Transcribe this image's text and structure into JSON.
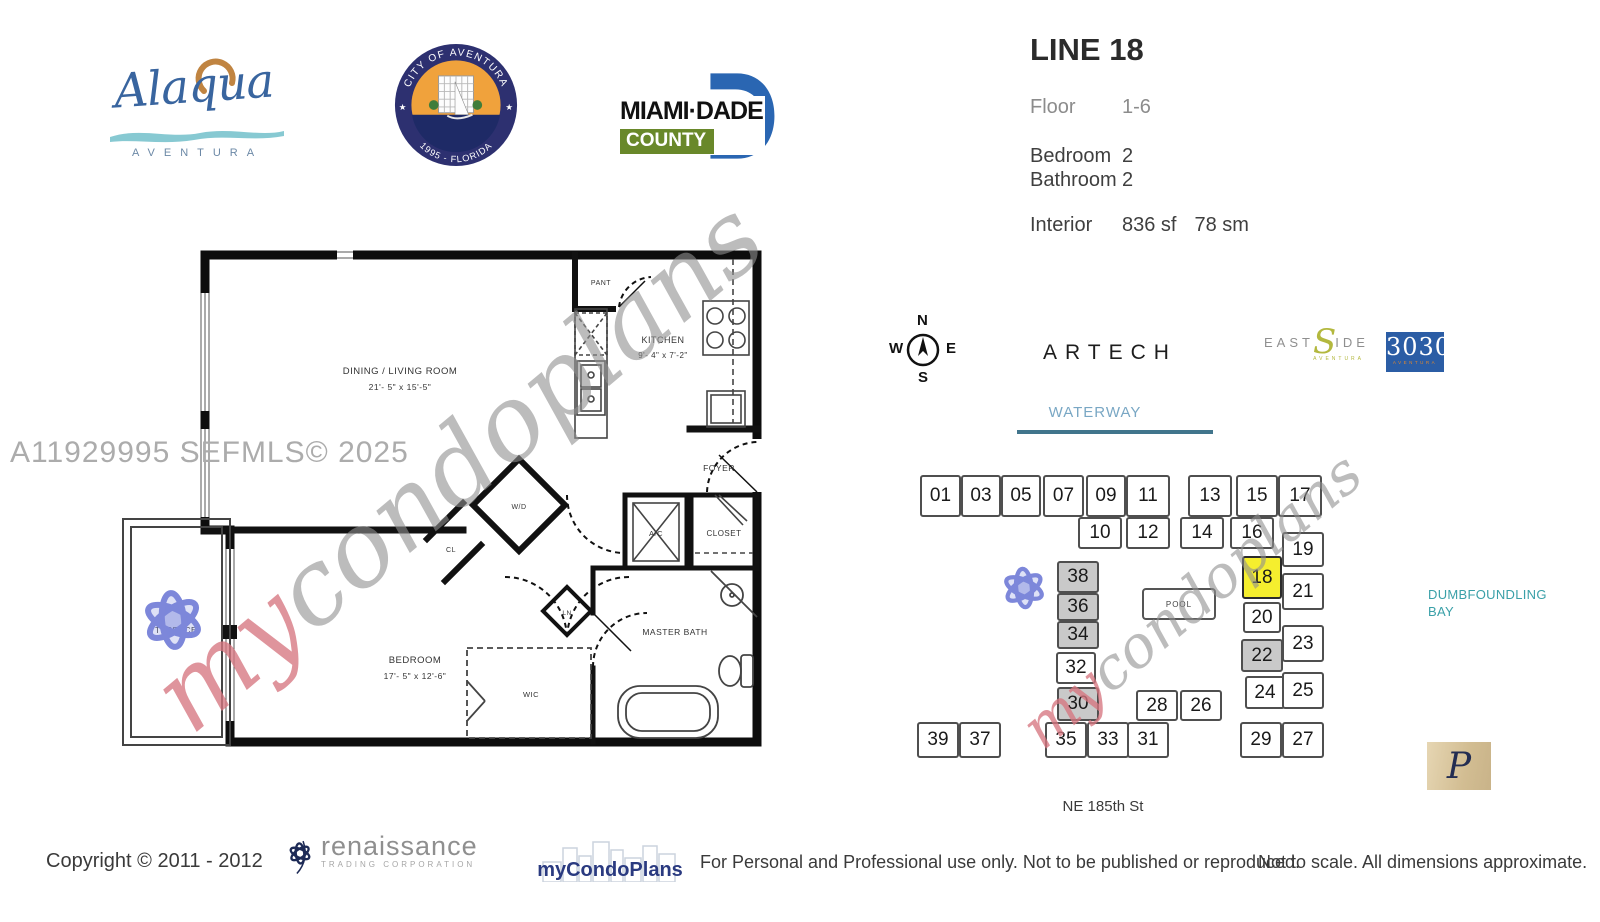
{
  "header": {
    "alaqua": {
      "name": "Alaqua",
      "subtitle": "AVENTURA"
    },
    "seal": {
      "arc_top": "CITY OF AVENTURA",
      "arc_bottom": "1995 - FLORIDA",
      "star": "★"
    },
    "miamidade": {
      "name": "MIAMI·DADE",
      "county": "COUNTY"
    }
  },
  "info": {
    "title": "LINE 18",
    "floor_label": "Floor",
    "floor_value": "1-6",
    "bedroom_label": "Bedroom",
    "bedroom_value": "2",
    "bathroom_label": "Bathroom",
    "bathroom_value": "2",
    "interior_label": "Interior",
    "interior_sf": "836 sf",
    "interior_sm": "78 sm"
  },
  "compass": {
    "n": "N",
    "e": "E",
    "s": "S",
    "w": "W"
  },
  "brands": {
    "artech": "ARTECH",
    "eastside": {
      "east": "EAST",
      "s": "S",
      "ide": "IDE",
      "sub": "AVENTURA"
    },
    "t3030": {
      "num": "3030",
      "sub": "AVENTURA"
    },
    "p_logo": "P"
  },
  "sitemap": {
    "waterway": "WATERWAY",
    "street": "NE 185th St",
    "bay": [
      "DUMBFOUNDLING",
      "BAY"
    ],
    "pool": "POOL",
    "highlight_color": "#f5ee2e",
    "shaded_color": "#c9c9c9",
    "units": [
      {
        "n": "01",
        "x": 920,
        "y": 475,
        "w": 41,
        "h": 42
      },
      {
        "n": "03",
        "x": 961,
        "y": 475,
        "w": 40,
        "h": 42
      },
      {
        "n": "05",
        "x": 1001,
        "y": 475,
        "w": 40,
        "h": 42
      },
      {
        "n": "07",
        "x": 1043,
        "y": 475,
        "w": 41,
        "h": 42
      },
      {
        "n": "09",
        "x": 1086,
        "y": 475,
        "w": 40,
        "h": 42
      },
      {
        "n": "11",
        "x": 1126,
        "y": 475,
        "w": 44,
        "h": 42
      },
      {
        "n": "13",
        "x": 1188,
        "y": 475,
        "w": 44,
        "h": 42
      },
      {
        "n": "15",
        "x": 1236,
        "y": 475,
        "w": 42,
        "h": 42
      },
      {
        "n": "17",
        "x": 1278,
        "y": 475,
        "w": 44,
        "h": 42
      },
      {
        "n": "10",
        "x": 1078,
        "y": 517,
        "w": 44,
        "h": 32
      },
      {
        "n": "12",
        "x": 1126,
        "y": 517,
        "w": 44,
        "h": 32
      },
      {
        "n": "14",
        "x": 1180,
        "y": 517,
        "w": 44,
        "h": 32
      },
      {
        "n": "16",
        "x": 1230,
        "y": 517,
        "w": 44,
        "h": 32
      },
      {
        "n": "19",
        "x": 1282,
        "y": 532,
        "w": 42,
        "h": 35
      },
      {
        "n": "38",
        "x": 1057,
        "y": 561,
        "w": 42,
        "h": 32,
        "c": "gray"
      },
      {
        "n": "36",
        "x": 1057,
        "y": 593,
        "w": 42,
        "h": 28,
        "c": "gray"
      },
      {
        "n": "34",
        "x": 1057,
        "y": 621,
        "w": 42,
        "h": 28,
        "c": "gray"
      },
      {
        "n": "32",
        "x": 1056,
        "y": 652,
        "w": 40,
        "h": 32
      },
      {
        "n": "30",
        "x": 1057,
        "y": 687,
        "w": 42,
        "h": 34,
        "c": "gray"
      },
      {
        "n": "18",
        "x": 1242,
        "y": 556,
        "w": 40,
        "h": 43,
        "c": "yellow"
      },
      {
        "n": "20",
        "x": 1243,
        "y": 602,
        "w": 38,
        "h": 31
      },
      {
        "n": "21",
        "x": 1282,
        "y": 573,
        "w": 42,
        "h": 37
      },
      {
        "n": "22",
        "x": 1241,
        "y": 639,
        "w": 42,
        "h": 33,
        "c": "gray"
      },
      {
        "n": "23",
        "x": 1282,
        "y": 625,
        "w": 42,
        "h": 37
      },
      {
        "n": "24",
        "x": 1245,
        "y": 676,
        "w": 40,
        "h": 33
      },
      {
        "n": "25",
        "x": 1282,
        "y": 672,
        "w": 42,
        "h": 37
      },
      {
        "n": "28",
        "x": 1136,
        "y": 690,
        "w": 42,
        "h": 31
      },
      {
        "n": "26",
        "x": 1180,
        "y": 690,
        "w": 42,
        "h": 31
      },
      {
        "n": "39",
        "x": 917,
        "y": 722,
        "w": 42,
        "h": 36
      },
      {
        "n": "37",
        "x": 959,
        "y": 722,
        "w": 42,
        "h": 36
      },
      {
        "n": "35",
        "x": 1045,
        "y": 722,
        "w": 42,
        "h": 36
      },
      {
        "n": "33",
        "x": 1087,
        "y": 722,
        "w": 42,
        "h": 36
      },
      {
        "n": "31",
        "x": 1127,
        "y": 722,
        "w": 42,
        "h": 36
      },
      {
        "n": "29",
        "x": 1240,
        "y": 722,
        "w": 42,
        "h": 36
      },
      {
        "n": "27",
        "x": 1282,
        "y": 722,
        "w": 42,
        "h": 36
      }
    ]
  },
  "floorplan": {
    "dining_name": "DINING / LIVING ROOM",
    "dining_dims": "21'- 5\" x 15'-5\"",
    "kitchen_name": "KITCHEN",
    "kitchen_dims": "9'- 4\" x 7'-2\"",
    "bedroom_name": "BEDROOM",
    "bedroom_dims": "17'- 5\" x 12'-6\"",
    "pantry": "PANT",
    "foyer": "FOYER",
    "wd": "W/D",
    "cl": "CL",
    "ac": "A/C",
    "closet": "CLOSET",
    "linen": "LN",
    "wic": "WIC",
    "master_bath": "MASTER BATH",
    "terrace": "TERRACE"
  },
  "watermark": {
    "mls": "A11929995  SEFMLS© 2025",
    "my": "my",
    "rest": "condoplans"
  },
  "footer": {
    "copyright": "Copyright © 2011 - 2012",
    "renaissance": "renaissance",
    "renaissance_sub": "TRADING CORPORATION",
    "mycondoplans": "myCondoPlans",
    "disclaimer": "For Personal and Professional use only.  Not to be published or reproduced.",
    "scale_note": "Not to scale.  All dimensions approximate."
  }
}
